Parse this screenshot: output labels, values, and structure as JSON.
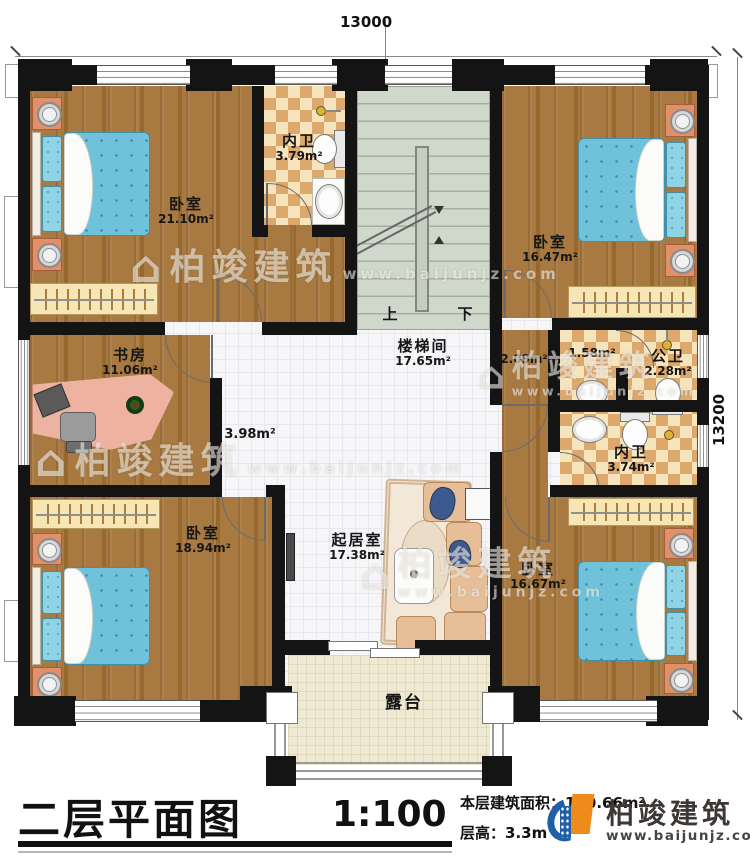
{
  "dimensions": {
    "top": "13000",
    "right": "13200"
  },
  "rooms": {
    "bedroom_tl": {
      "name": "卧室",
      "area": "21.10m²"
    },
    "bath_top": {
      "name": "内卫",
      "area": "3.79m²"
    },
    "bedroom_tr": {
      "name": "卧室",
      "area": "16.47m²"
    },
    "study": {
      "name": "书房",
      "area": "11.06m²"
    },
    "stairwell": {
      "name": "楼梯间",
      "area": "17.65m²"
    },
    "hall": {
      "area": "3.98m²"
    },
    "corridor": {
      "area": "2.09m²"
    },
    "bath_lobby": {
      "area": "1.58m²"
    },
    "public_bath": {
      "name": "公卫",
      "area": "2.28m²"
    },
    "bath_right": {
      "name": "内卫",
      "area": "3.74m²"
    },
    "bedroom_bl": {
      "name": "卧室",
      "area": "18.94m²"
    },
    "living": {
      "name": "起居室",
      "area": "17.38m²"
    },
    "bedroom_br": {
      "name": "卧室",
      "area": "16.67m²"
    },
    "terrace": {
      "name": "露台"
    }
  },
  "stairs": {
    "up": "上",
    "down": "下"
  },
  "footer": {
    "title": "二层平面图",
    "scale": "1:100",
    "area_label": "本层建筑面积：",
    "area_value": "160.66m²",
    "height_label": "层高：",
    "height_value": "3.3m"
  },
  "brand": {
    "name": "柏竣建筑",
    "url": "www.baijunjz.com"
  },
  "watermark": {
    "icon": "⌂",
    "name": "柏竣建筑",
    "url": "www.baijunjz.com"
  },
  "colors": {
    "wall": "#141414",
    "wood": "#a5783e",
    "tile": "#f6f6f8",
    "checker": "#dca86b",
    "stairs": "#d0d8cb",
    "terrace": "#efe8d2",
    "bed": "#6fc2da",
    "logo_blue": "#1f5fa8",
    "logo_orange": "#ef8b1d"
  }
}
